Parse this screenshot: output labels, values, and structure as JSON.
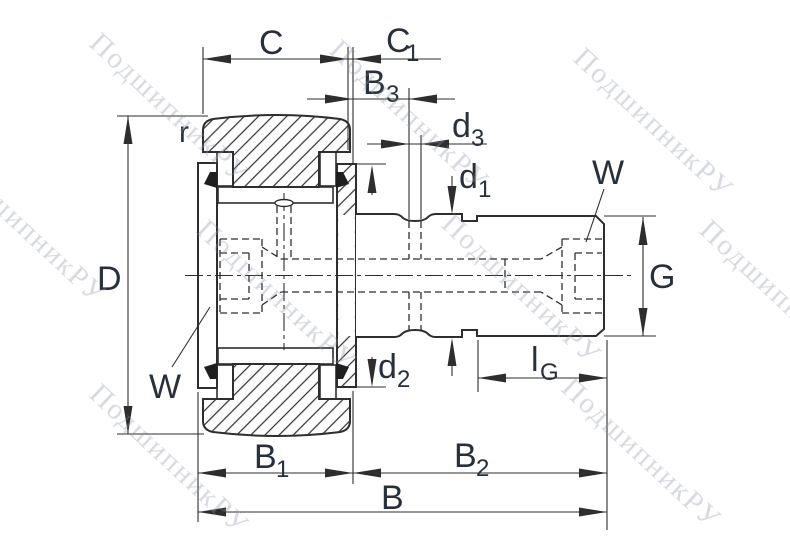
{
  "drawing": {
    "type": "bearing-cross-section-drawing",
    "watermark": "ПодшипникРУ",
    "colors": {
      "line": "#2e2e2e",
      "label": "#28303c",
      "watermark": "#8d95a5",
      "background": "#ffffff"
    },
    "dims": {
      "C": {
        "m": "C",
        "s": ""
      },
      "C1": {
        "m": "C",
        "s": "1"
      },
      "B3": {
        "m": "B",
        "s": "3"
      },
      "d3": {
        "m": "d",
        "s": "3"
      },
      "d1": {
        "m": "d",
        "s": "1"
      },
      "W_top": {
        "m": "W",
        "s": ""
      },
      "G": {
        "m": "G",
        "s": ""
      },
      "lG": {
        "m": "l",
        "s": "G"
      },
      "d2": {
        "m": "d",
        "s": "2"
      },
      "D": {
        "m": "D",
        "s": ""
      },
      "W_left": {
        "m": "W",
        "s": ""
      },
      "r": {
        "m": "r",
        "s": ""
      },
      "B1": {
        "m": "B",
        "s": "1"
      },
      "B2": {
        "m": "B",
        "s": "2"
      },
      "B": {
        "m": "B",
        "s": ""
      }
    }
  }
}
